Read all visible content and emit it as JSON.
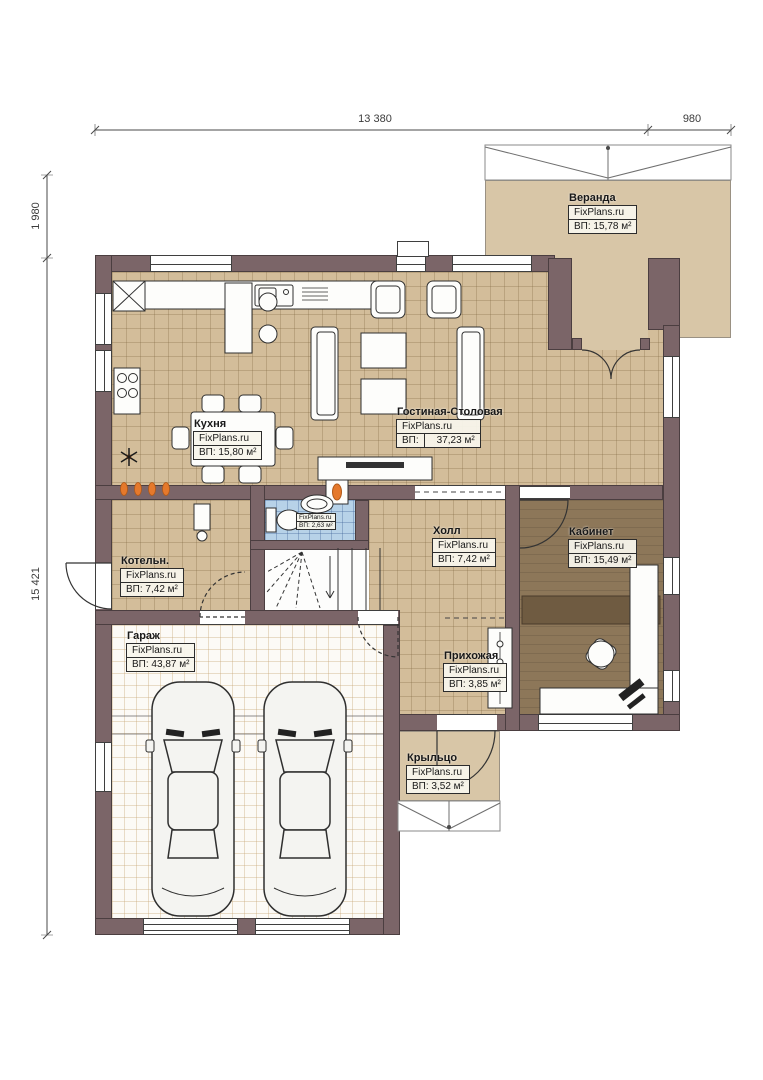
{
  "dimensions": {
    "top_main": "13 380",
    "top_right": "980",
    "left_upper": "1 980",
    "left_main": "15 421"
  },
  "rooms": {
    "veranda": {
      "name": "Веранда",
      "brand": "FixPlans.ru",
      "area": "ВП: 15,78 м²"
    },
    "kitchen": {
      "name": "Кухня",
      "brand": "FixPlans.ru",
      "area": "ВП: 15,80 м²"
    },
    "living": {
      "name": "Гостиная-Столовая",
      "brand": "FixPlans.ru",
      "area_label": "ВП:",
      "area_value": "37,23 м²"
    },
    "bathroom": {
      "brand": "FixPlans.ru",
      "area": "ВП: 2,63 м²"
    },
    "boiler": {
      "name": "Котельн.",
      "brand": "FixPlans.ru",
      "area": "ВП: 7,42 м²"
    },
    "hall": {
      "name": "Холл",
      "brand": "FixPlans.ru",
      "area": "ВП: 7,42 м²"
    },
    "study": {
      "name": "Кабинет",
      "brand": "FixPlans.ru",
      "area": "ВП: 15,49 м²"
    },
    "garage": {
      "name": "Гараж",
      "brand": "FixPlans.ru",
      "area": "ВП: 43,87 м²"
    },
    "hallway": {
      "name": "Прихожая",
      "brand": "FixPlans.ru",
      "area": "ВП: 3,85 м²"
    },
    "porch": {
      "name": "Крыльцо",
      "brand": "FixPlans.ru",
      "area": "ВП: 3,52 м²"
    }
  },
  "colors": {
    "wall": "#7b6568",
    "floor_tile": "#d3bd9a",
    "floor_wood": "#8d7759",
    "floor_bath": "#b7d2e8",
    "floor_veranda": "#d8c6a7",
    "flame_accent": "#e5792c"
  }
}
